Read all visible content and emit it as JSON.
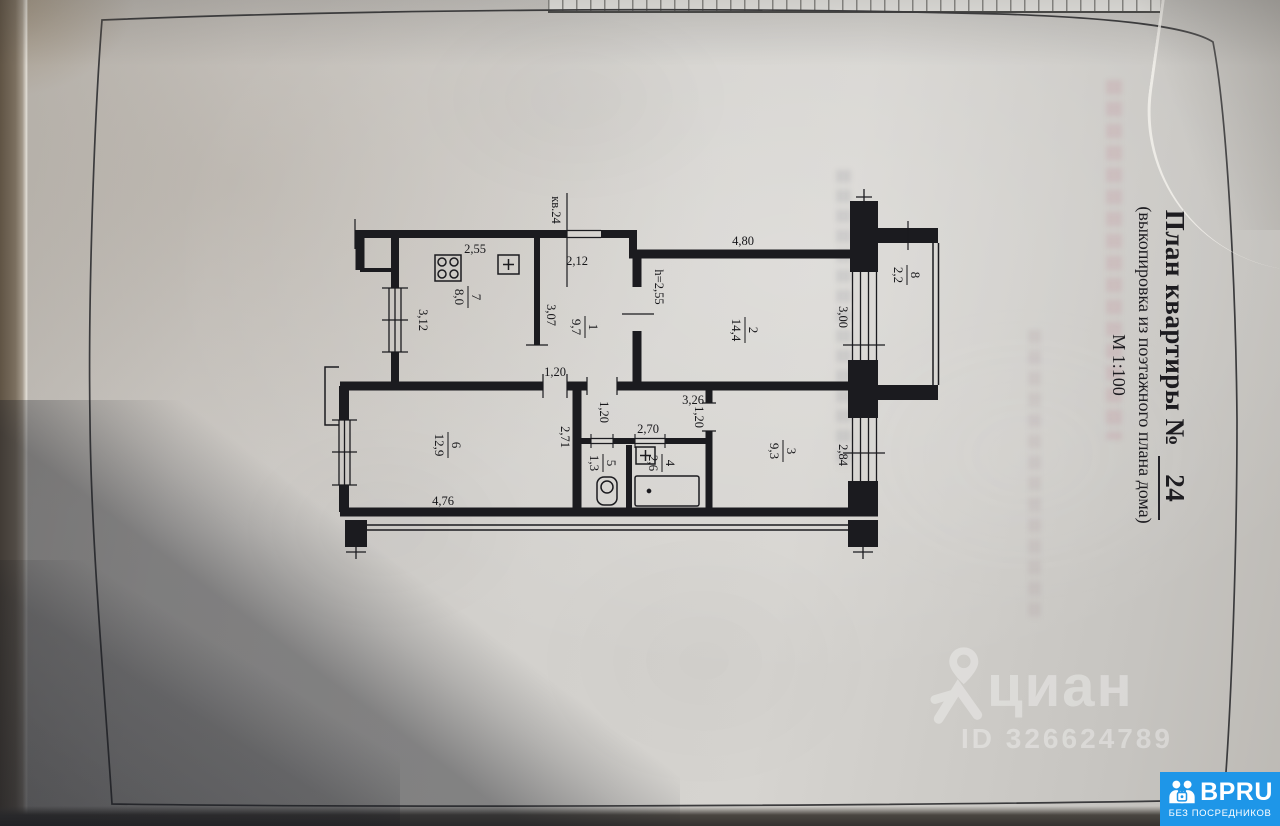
{
  "title_block": {
    "title": "План квартиры №",
    "number": "24",
    "subtitle": "(выкопировка из поэтажного плана дома)",
    "scale": "М 1:100"
  },
  "plan": {
    "apartment_label": "кв.24",
    "height_note": "h=2,55",
    "rooms": [
      {
        "number": "1",
        "area": "9,7"
      },
      {
        "number": "2",
        "area": "14,4"
      },
      {
        "number": "3",
        "area": "9,3"
      },
      {
        "number": "4",
        "area": "2,6"
      },
      {
        "number": "5",
        "area": "1,3"
      },
      {
        "number": "6",
        "area": "12,9"
      },
      {
        "number": "7",
        "area": "8,0"
      },
      {
        "number": "8",
        "area": "2,2"
      }
    ],
    "dims": {
      "kitchen_width": "2,55",
      "kitchen_depth": "3,12",
      "hall_width": "2,12",
      "hall_depth": "3,07",
      "room2_width": "4,80",
      "room2_depth": "3,00",
      "room3_width": "3,26",
      "room3_depth": "2,84",
      "room6_width": "4,76",
      "room6_depth": "2,71",
      "inner_hall_door": "1,20",
      "inner_hall_width": "1,20",
      "room3_door": "1,20",
      "bath_block_width": "2,70"
    }
  },
  "watermark": {
    "brand": "циан",
    "listing_id": "ID 326624789"
  },
  "badge": {
    "brand": "BPRU",
    "tagline": "БЕЗ ПОСРЕДНИКОВ",
    "color": "#1e96e8"
  }
}
